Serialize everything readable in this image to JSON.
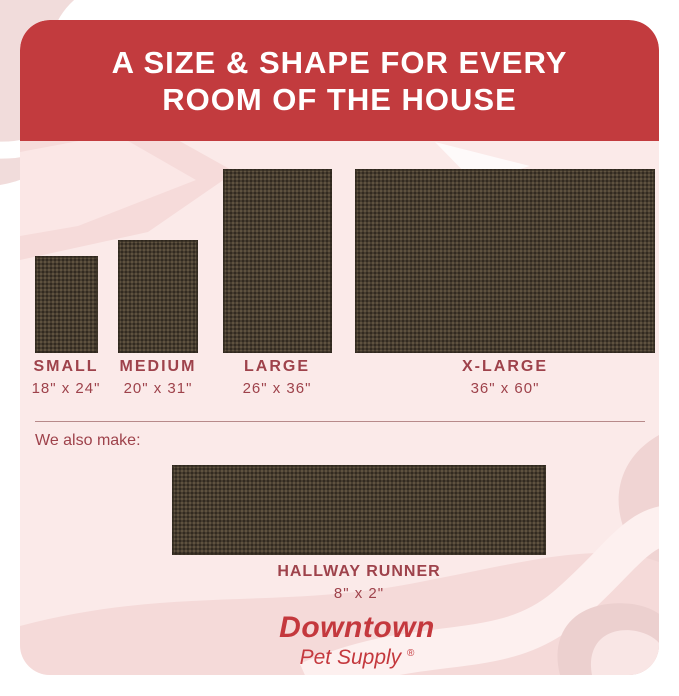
{
  "header": {
    "title_line1": "A SIZE & SHAPE FOR EVERY",
    "title_line2": "ROOM OF THE HOUSE"
  },
  "mats": [
    {
      "name": "SMALL",
      "dimensions": "18\" x 24\""
    },
    {
      "name": "MEDIUM",
      "dimensions": "20\" x 31\""
    },
    {
      "name": "LARGE",
      "dimensions": "26\" x 36\""
    },
    {
      "name": "X-LARGE",
      "dimensions": "36\" x 60\""
    }
  ],
  "also_make": {
    "label": "We also make:"
  },
  "runner": {
    "name": "HALLWAY RUNNER",
    "dimensions": "8\" x 2\""
  },
  "brand": {
    "name": "Downtown",
    "subtitle": "Pet Supply",
    "registered": "®"
  },
  "colors": {
    "banner_red": "#c23b3e",
    "panel_bg": "#fbeae9",
    "label_maroon": "#9e424b",
    "mat_brown": "#473d30",
    "mat_dot": "#6a5e49",
    "logo_red": "#c4383d",
    "decor_pink": "#f4d9d8",
    "decor_pink_dark": "#eccfce"
  }
}
